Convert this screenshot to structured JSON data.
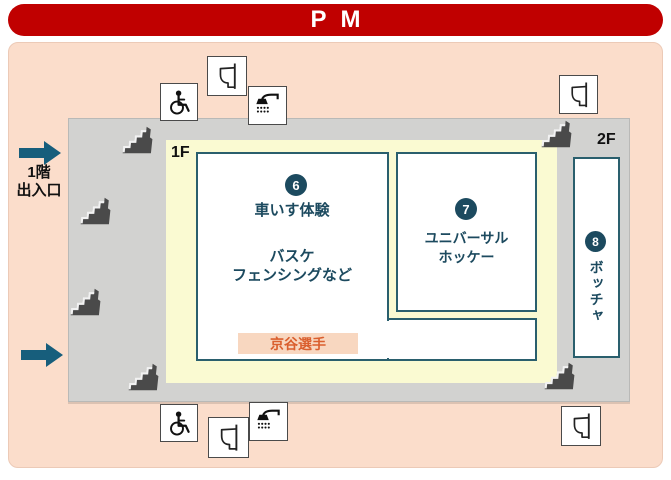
{
  "header": {
    "title": "PM"
  },
  "floor_labels": {
    "f1": "1F",
    "f2": "2F"
  },
  "entrance": {
    "line1": "1階",
    "line2": "出入口"
  },
  "rooms": {
    "wheelchair_experience": {
      "number": "6",
      "title": "車いす体験",
      "sub1": "バスケ",
      "sub2": "フェンシングなど"
    },
    "universal_hockey": {
      "number": "7",
      "line1": "ユニバーサル",
      "line2": "ホッケー"
    },
    "boccia": {
      "number": "8",
      "name": "ボッチャ"
    }
  },
  "player_tag": {
    "label": "京谷選手"
  },
  "icons": {
    "toilet": {
      "name": "toilet-icon",
      "glyph": "svg-toilet-side-view"
    },
    "wheelchair": {
      "name": "wheelchair-accessible-icon",
      "glyph": "svg-wheelchair-symbol"
    },
    "shower": {
      "name": "shower-icon",
      "glyph": "svg-showerhead-with-spray"
    },
    "stairs": {
      "name": "stairs-icon",
      "glyph": "svg-isometric-stairs"
    },
    "arrow": {
      "name": "entrance-arrow-icon",
      "glyph": "svg-right-arrow"
    }
  },
  "colors": {
    "header_bg": "#c00000",
    "panel_bg": "#fbddcb",
    "building_bg": "#d2d2d0",
    "floor_bg": "#fafad2",
    "room_border": "#2a5f6d",
    "accent": "#1c4a5f",
    "player_bg": "#f8d7c0",
    "player_text": "#da5f2e",
    "arrow": "#175e7c",
    "stairs": "#4a4a4a"
  }
}
